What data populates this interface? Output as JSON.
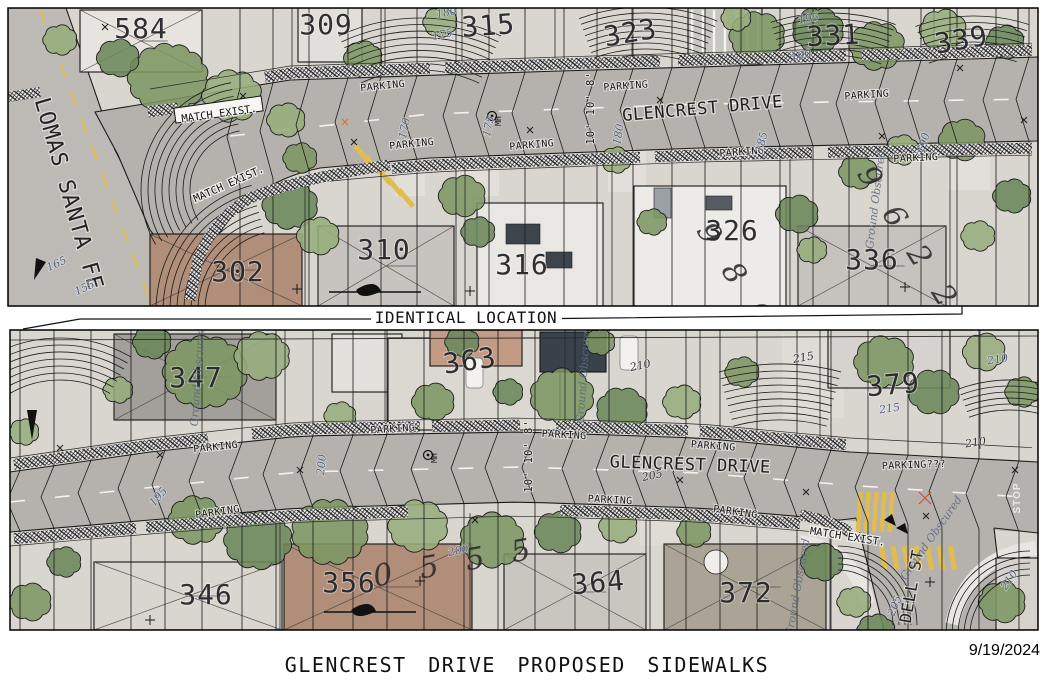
{
  "title": "GLENCREST DRIVE PROPOSED SIDEWALKS",
  "date": "9/19/2024",
  "separator": {
    "label": "IDENTICAL LOCATION"
  },
  "streets": {
    "glencrest": "GLENCREST DRIVE",
    "lomas": "LOMAS SANTA FE",
    "dell": "DELL ST"
  },
  "notes": {
    "parking": "PARKING",
    "parking_unknown": "PARKING???",
    "match_exist": "MATCH EXIST.",
    "manhole": "MH",
    "lane_widths": "10' 10' 8'",
    "ground_obscured": "Ground Obscured",
    "stop": "STOP"
  },
  "top": {
    "houses": [
      "584",
      "309",
      "315",
      "323",
      "331",
      "339",
      "302",
      "310",
      "316",
      "326",
      "336"
    ],
    "contours": [
      "180",
      "175",
      "195",
      "190",
      "170",
      "175",
      "180",
      "185",
      "190",
      "165",
      "155"
    ],
    "spots": [
      "9 8 6",
      "9 6 2 2"
    ]
  },
  "bottom": {
    "houses": [
      "347",
      "363",
      "379",
      "346",
      "356",
      "364",
      "372"
    ],
    "contours": [
      "195",
      "200",
      "200",
      "205",
      "210",
      "215",
      "215",
      "210",
      "210",
      "205",
      "210"
    ],
    "spots": [
      "0 5 5 5"
    ]
  },
  "colors": {
    "paper": "#ffffff",
    "ink": "#1b1b1b",
    "asphalt": "#b5b2ae",
    "parcel": "#d9d6d0",
    "concrete": "#e8e6e2",
    "contour_label": "#4e5d80",
    "vegetation": [
      "#7d9663",
      "#97ad7c",
      "#6b875a",
      "#a9ba90"
    ],
    "marking_yellow": "#e0bd4e",
    "marking_white": "#f2f1ee",
    "roof_brown": "#b08e79",
    "alert_red": "#cf4a2d"
  }
}
